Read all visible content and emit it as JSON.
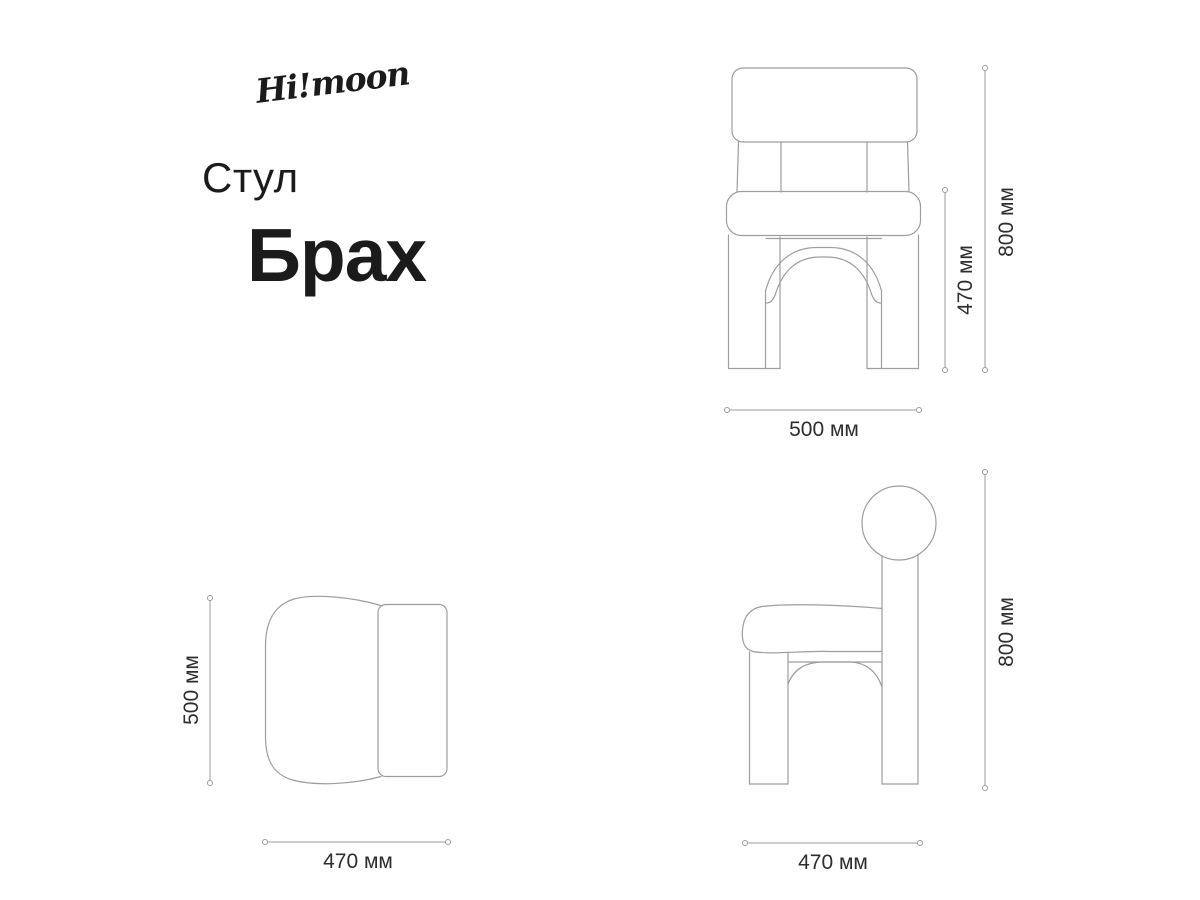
{
  "header": {
    "brand_logo": "Hi!moon",
    "product_type": "Стул",
    "product_name": "Брах"
  },
  "views": {
    "front": {
      "seat_height": "470 мм",
      "overall_height": "800 мм",
      "overall_width": "500 мм"
    },
    "top": {
      "seat_depth": "500 мм",
      "seat_width": "470 мм"
    },
    "side": {
      "overall_height": "800 мм",
      "overall_depth": "470 мм"
    }
  },
  "colors": {
    "background": "#ffffff",
    "drawing_line": "#9e9e9e",
    "dimension_line": "#9b9b9b",
    "dimension_text": "#2d2d2d",
    "title_text": "#1b1b1b"
  }
}
